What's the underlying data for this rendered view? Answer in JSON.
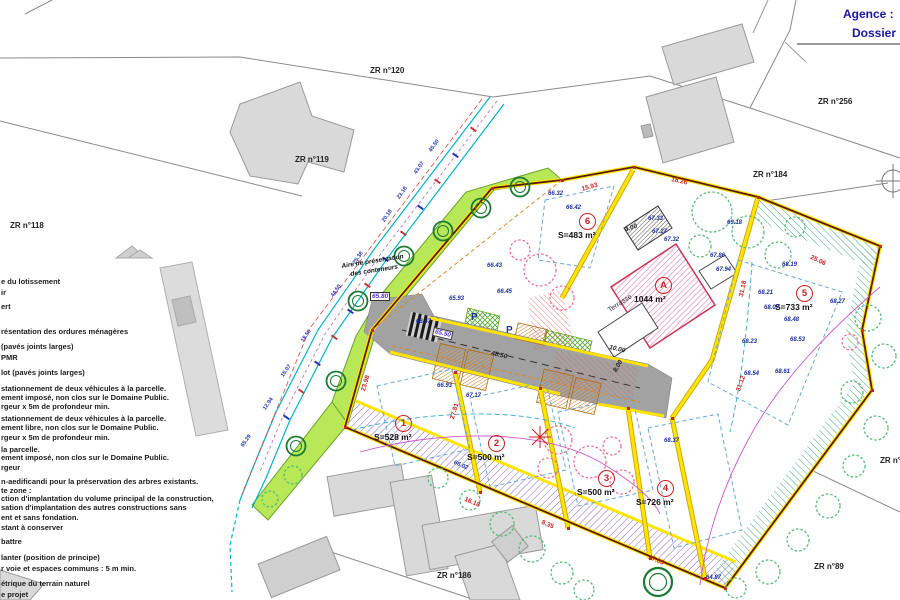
{
  "title_block": {
    "agence": "Agence :",
    "dossier": "Dossier"
  },
  "colors": {
    "boundary_yellow": "#ffe400",
    "site_line": "#5a1a14",
    "green_space": "#b8e858",
    "road_gray": "#a2a2a2",
    "tree_keep": "#1a7a33",
    "tree_fell": "#ee6688",
    "hatch_purple": "#8866cc",
    "dim_red": "#cc2222",
    "dim_blue": "#2233bb",
    "title_navy": "#1b16a0",
    "parcel_red": "#c92222"
  },
  "legend": {
    "items": [
      {
        "text": "e du lotissement",
        "y": 277
      },
      {
        "text": "ir",
        "y": 288
      },
      {
        "text": "ert",
        "y": 302
      },
      {
        "text": "résentation des ordures ménagères",
        "y": 327
      },
      {
        "text": "(pavés joints larges)",
        "y": 342
      },
      {
        "text": "PMR",
        "y": 353
      },
      {
        "text": "lot (pavés joints larges)",
        "y": 368
      },
      {
        "text": "stationnement de deux véhicules à la parcelle.",
        "y": 384
      },
      {
        "text": "ement imposé, non clos sur le Domaine Public.",
        "y": 393
      },
      {
        "text": "rgeur x 5m de profondeur min.",
        "y": 402
      },
      {
        "text": "stationnement de deux véhicules à la parcelle.",
        "y": 414
      },
      {
        "text": "ement libre, non clos sur le Domaine Public.",
        "y": 423
      },
      {
        "text": "rgeur x 5m de profondeur min.",
        "y": 433
      },
      {
        "text": "la parcelle.",
        "y": 445
      },
      {
        "text": "ement imposé, non clos sur le Domaine Public.",
        "y": 453
      },
      {
        "text": "rgeur",
        "y": 463
      },
      {
        "text": "n-aedificandi pour la préservation des arbres existants.",
        "y": 477
      },
      {
        "text": "te zone :",
        "y": 486
      },
      {
        "text": "ction d'implantation du volume principal de la construction,",
        "y": 494
      },
      {
        "text": "sation d'implantation des autres constructions sans",
        "y": 503
      },
      {
        "text": "ent et sans fondation.",
        "y": 513
      },
      {
        "text": "stant à conserver",
        "y": 523
      },
      {
        "text": "battre",
        "y": 537
      },
      {
        "text": "lanter (position de principe)",
        "y": 553
      },
      {
        "text": "r voie et espaces communs : 5 m min.",
        "y": 564
      },
      {
        "text": "étrique du terrain naturel",
        "y": 579
      },
      {
        "text": "e projet",
        "y": 590
      }
    ]
  },
  "context": {
    "zr_labels": [
      {
        "text": "ZR n°120",
        "x": 370,
        "y": 66
      },
      {
        "text": "ZR n°119",
        "x": 295,
        "y": 155
      },
      {
        "text": "ZR n°118",
        "x": 10,
        "y": 221
      },
      {
        "text": "ZR n°256",
        "x": 818,
        "y": 97
      },
      {
        "text": "ZR n°184",
        "x": 753,
        "y": 170
      },
      {
        "text": "ZR n°186",
        "x": 437,
        "y": 571
      },
      {
        "text": "ZR n°89",
        "x": 814,
        "y": 562
      },
      {
        "text": "ZR n°",
        "x": 880,
        "y": 456
      }
    ]
  },
  "parcels": {
    "items": [
      {
        "num": "1",
        "area": "S=528 m²",
        "x": 404,
        "y": 424
      },
      {
        "num": "2",
        "area": "S=500 m²",
        "x": 497,
        "y": 444
      },
      {
        "num": "3",
        "area": "S=500 m²",
        "x": 607,
        "y": 479
      },
      {
        "num": "4",
        "area": "S=726 m²",
        "x": 666,
        "y": 489
      },
      {
        "num": "5",
        "area": "S=733 m²",
        "x": 805,
        "y": 294
      },
      {
        "num": "6",
        "area": "S=483 m²",
        "x": 588,
        "y": 222
      },
      {
        "num": "A",
        "area": "1044 m²",
        "x": 664,
        "y": 286
      }
    ]
  },
  "map_texts": {
    "misc": [
      {
        "text": "Aire de présentation",
        "x": 341,
        "y": 263,
        "rot": -9,
        "cls": "aire"
      },
      {
        "text": "des conteneurs",
        "x": 350,
        "y": 271,
        "rot": -9,
        "cls": "aire"
      },
      {
        "text": "Terrasse",
        "x": 607,
        "y": 308,
        "rot": -33,
        "cls": "terrasse"
      },
      {
        "text": "P",
        "x": 471,
        "y": 312,
        "cls": "p-label"
      },
      {
        "text": "P",
        "x": 506,
        "y": 325,
        "cls": "p-label"
      }
    ],
    "boxed": [
      {
        "text": "65.80",
        "x": 370,
        "y": 292
      },
      {
        "text": "65.50",
        "x": 434,
        "y": 327,
        "rot": 13
      }
    ],
    "road_dims": [
      {
        "text": "48.50",
        "x": 492,
        "y": 350,
        "rot": 13
      },
      {
        "text": "10.00",
        "x": 610,
        "y": 344,
        "rot": 13
      },
      {
        "text": "8.00",
        "x": 612,
        "y": 370,
        "rot": -60
      },
      {
        "text": "4.00",
        "x": 624,
        "y": 227,
        "rot": -20
      }
    ],
    "red_dims": [
      {
        "text": "27.81",
        "x": 449,
        "y": 418,
        "rot": -73
      },
      {
        "text": "23.98",
        "x": 360,
        "y": 390,
        "rot": -73
      },
      {
        "text": "31.12",
        "x": 735,
        "y": 390,
        "rot": -70
      },
      {
        "text": "31.18",
        "x": 738,
        "y": 296,
        "rot": -78
      },
      {
        "text": "16.18",
        "x": 466,
        "y": 496,
        "rot": 23
      },
      {
        "text": "8.35",
        "x": 543,
        "y": 519,
        "rot": 23
      },
      {
        "text": "17.05",
        "x": 650,
        "y": 554,
        "rot": 23
      },
      {
        "text": "25.06",
        "x": 812,
        "y": 254,
        "rot": 25
      },
      {
        "text": "15.93",
        "x": 581,
        "y": 186,
        "rot": -15
      },
      {
        "text": "18.26",
        "x": 672,
        "y": 176,
        "rot": 13
      }
    ],
    "elevations": [
      {
        "text": "66.32",
        "x": 548,
        "y": 191
      },
      {
        "text": "66.42",
        "x": 566,
        "y": 205
      },
      {
        "text": "66.43",
        "x": 487,
        "y": 263
      },
      {
        "text": "65.93",
        "x": 449,
        "y": 296
      },
      {
        "text": "66.47",
        "x": 416,
        "y": 319
      },
      {
        "text": "66.45",
        "x": 497,
        "y": 289
      },
      {
        "text": "66.93",
        "x": 437,
        "y": 383
      },
      {
        "text": "67.33",
        "x": 648,
        "y": 216
      },
      {
        "text": "67.27",
        "x": 652,
        "y": 229
      },
      {
        "text": "67.32",
        "x": 664,
        "y": 237
      },
      {
        "text": "69.18",
        "x": 727,
        "y": 220
      },
      {
        "text": "67.86",
        "x": 710,
        "y": 253
      },
      {
        "text": "67.94",
        "x": 716,
        "y": 267
      },
      {
        "text": "68.19",
        "x": 782,
        "y": 262
      },
      {
        "text": "68.21",
        "x": 758,
        "y": 290
      },
      {
        "text": "68.07",
        "x": 764,
        "y": 305
      },
      {
        "text": "68.48",
        "x": 784,
        "y": 317
      },
      {
        "text": "68.53",
        "x": 790,
        "y": 337
      },
      {
        "text": "68.23",
        "x": 742,
        "y": 339
      },
      {
        "text": "68.54",
        "x": 744,
        "y": 371
      },
      {
        "text": "68.61",
        "x": 775,
        "y": 369
      },
      {
        "text": "68.27",
        "x": 830,
        "y": 299
      },
      {
        "text": "68.37",
        "x": 664,
        "y": 438
      },
      {
        "text": "67.17",
        "x": 466,
        "y": 393
      },
      {
        "text": "66.02",
        "x": 455,
        "y": 460,
        "rot": 23
      },
      {
        "text": "64.87",
        "x": 706,
        "y": 575
      }
    ],
    "blue_dims": [
      {
        "text": "45.50",
        "x": 428,
        "y": 150,
        "rot": -55
      },
      {
        "text": "43.07",
        "x": 413,
        "y": 172,
        "rot": -55
      },
      {
        "text": "23.18",
        "x": 396,
        "y": 197,
        "rot": -55
      },
      {
        "text": "20.18",
        "x": 381,
        "y": 220,
        "rot": -55
      },
      {
        "text": "25.38",
        "x": 352,
        "y": 262,
        "rot": -55
      },
      {
        "text": "44.50",
        "x": 330,
        "y": 295,
        "rot": -55
      },
      {
        "text": "18.50",
        "x": 300,
        "y": 340,
        "rot": -55
      },
      {
        "text": "15.07",
        "x": 280,
        "y": 375,
        "rot": -55
      },
      {
        "text": "12.94",
        "x": 262,
        "y": 408,
        "rot": -55
      },
      {
        "text": "65.29",
        "x": 240,
        "y": 445,
        "rot": -55
      }
    ]
  }
}
